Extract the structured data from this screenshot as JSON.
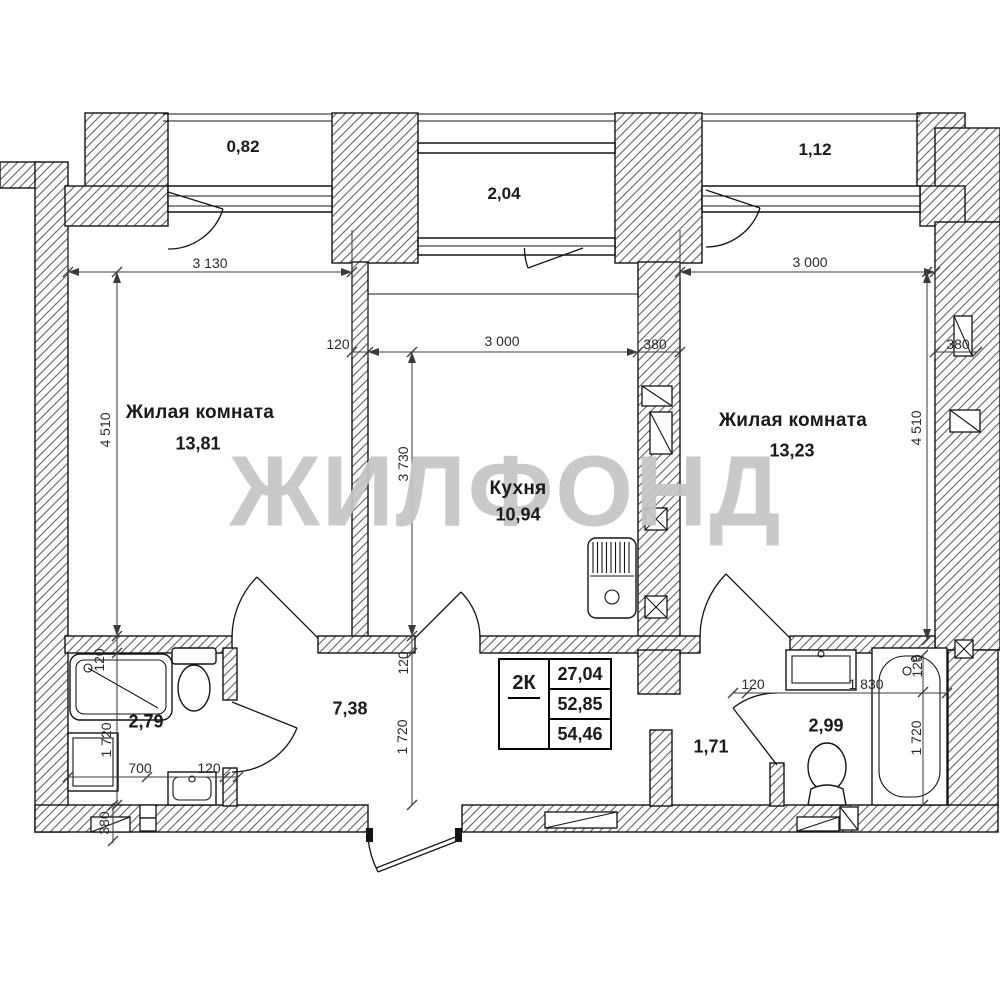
{
  "plan": {
    "watermark": "ЖИЛФОНД",
    "rooms": [
      {
        "name": "Жилая комната",
        "area": "13,81"
      },
      {
        "name": "Кухня",
        "area": "10,94"
      },
      {
        "name": "Жилая комната",
        "area": "13,23"
      }
    ],
    "balconies": [
      {
        "area": "0,82"
      },
      {
        "area": "2,04"
      },
      {
        "area": "1,12"
      }
    ],
    "zones": [
      {
        "area": "2,79"
      },
      {
        "area": "7,38"
      },
      {
        "area": "1,71"
      },
      {
        "area": "2,99"
      }
    ],
    "legend": {
      "type": "2К",
      "rows": [
        "27,04",
        "52,85",
        "54,46"
      ]
    },
    "dims": [
      "3 130",
      "3 000",
      "3 000",
      "120",
      "380",
      "380",
      "4 510",
      "3 730",
      "4 510",
      "120",
      "1 720",
      "120",
      "1 720",
      "700",
      "120",
      "380",
      "120",
      "1 830",
      "120",
      "1 720"
    ]
  }
}
